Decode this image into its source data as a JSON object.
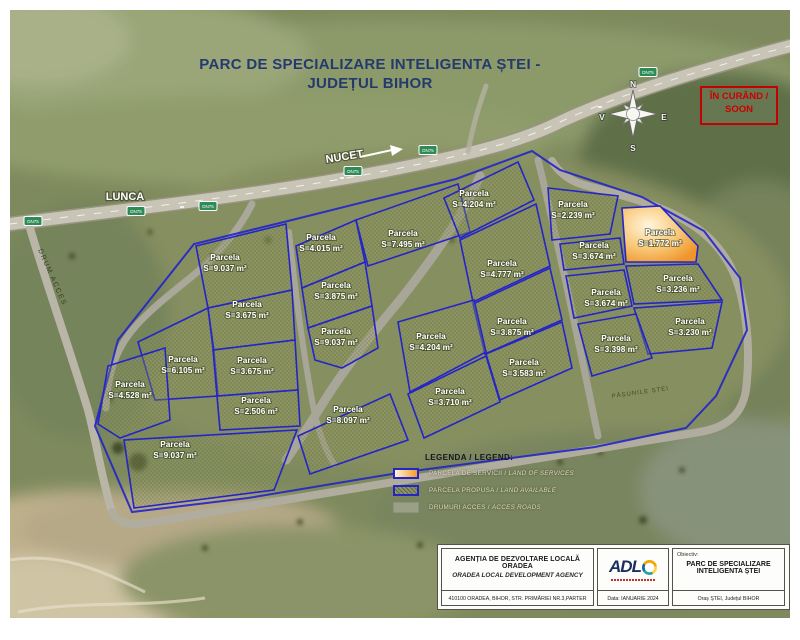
{
  "page": {
    "title_line1": "PARC DE SPECIALIZARE INTELIGENTA ȘTEI -",
    "title_line2": "JUDEȚUL BIHOR"
  },
  "colors": {
    "title": "#243a6e",
    "parcel_border": "#2424c8",
    "service_fill": "#f49c2c",
    "coming_soon_red": "#cc0000",
    "terrain_green": "#7e8a5d"
  },
  "map": {
    "coming_soon_line1": "ÎN CURÂND /",
    "coming_soon_line2": "SOON",
    "town_left": "LUNCA",
    "town_right": "NUCET",
    "access_road_label": "DRUM ACCES",
    "pasture_label": "PĂȘUNILE ȘTEI",
    "route_badge": "DN75",
    "compass": {
      "north": "N",
      "east": "E",
      "south": "S",
      "west": "V"
    },
    "parcel_word": "Parcela",
    "badges": [
      {
        "x": 33,
        "y": 221
      },
      {
        "x": 136,
        "y": 211
      },
      {
        "x": 208,
        "y": 206
      },
      {
        "x": 353,
        "y": 171
      },
      {
        "x": 428,
        "y": 150
      },
      {
        "x": 648,
        "y": 72
      }
    ],
    "service_parcel": {
      "area": "S=1.772 m²",
      "x": 660,
      "y": 237,
      "points": "622,208 660,206 698,246 696,262 626,262"
    },
    "parcels": [
      {
        "area": "S=9.037 m²",
        "x": 225,
        "y": 262,
        "points": "196,246 286,224 292,290 208,308"
      },
      {
        "area": "S=3.675 m²",
        "x": 247,
        "y": 309,
        "points": "208,308 292,290 295,340 213,350"
      },
      {
        "area": "S=6.105 m²",
        "x": 183,
        "y": 364,
        "points": "138,342 208,308 214,352 218,396 155,400"
      },
      {
        "area": "S=3.675 m²",
        "x": 252,
        "y": 365,
        "points": "213,350 295,340 298,390 217,396"
      },
      {
        "area": "S=4.528 m²",
        "x": 130,
        "y": 389,
        "points": "98,424 108,366 165,348 170,420 120,438"
      },
      {
        "area": "S=2.506 m²",
        "x": 256,
        "y": 405,
        "points": "217,396 298,390 300,426 220,430"
      },
      {
        "area": "S=9.037 m²",
        "x": 175,
        "y": 449,
        "points": "124,440 297,430 274,490 134,508"
      },
      {
        "area": "S=4.015 m²",
        "x": 321,
        "y": 242,
        "points": "296,246 356,220 365,262 302,288"
      },
      {
        "area": "S=7.495 m²",
        "x": 403,
        "y": 238,
        "points": "356,220 458,184 470,232 368,266"
      },
      {
        "area": "S=3.875 m²",
        "x": 336,
        "y": 290,
        "points": "302,288 365,262 372,306 308,328"
      },
      {
        "area": "S=9.037 m²",
        "x": 336,
        "y": 336,
        "points": "308,328 372,306 378,348 342,368 315,360"
      },
      {
        "area": "S=4.204 m²",
        "x": 474,
        "y": 198,
        "points": "444,198 518,162 534,200 460,238"
      },
      {
        "area": "S=4.777 m²",
        "x": 502,
        "y": 268,
        "points": "460,240 536,204 550,266 473,302"
      },
      {
        "area": "S=3.875 m²",
        "x": 512,
        "y": 326,
        "points": "473,304 550,268 562,320 485,354"
      },
      {
        "area": "S=4.204 m²",
        "x": 431,
        "y": 341,
        "points": "398,322 474,300 486,352 410,392"
      },
      {
        "area": "S=3.583 m²",
        "x": 524,
        "y": 367,
        "points": "486,354 562,322 572,368 500,400"
      },
      {
        "area": "S=3.710 m²",
        "x": 450,
        "y": 396,
        "points": "408,394 486,356 500,402 424,438"
      },
      {
        "area": "S=8.097 m²",
        "x": 348,
        "y": 414,
        "points": "298,436 390,394 408,440 310,474"
      },
      {
        "area": "S=2.239 m²",
        "x": 573,
        "y": 209,
        "points": "548,188 618,196 610,234 552,240"
      },
      {
        "area": "S=3.674 m²",
        "x": 594,
        "y": 250,
        "points": "560,244 620,238 624,264 564,270"
      },
      {
        "area": "S=3.236 m²",
        "x": 678,
        "y": 283,
        "points": "626,266 698,264 722,300 634,304"
      },
      {
        "area": "S=3.674 m²",
        "x": 606,
        "y": 297,
        "points": "566,276 624,270 632,306 574,318"
      },
      {
        "area": "S=3.230 m²",
        "x": 690,
        "y": 326,
        "points": "634,308 722,302 712,348 648,354"
      },
      {
        "area": "S=3.398 m²",
        "x": 616,
        "y": 343,
        "points": "578,324 636,314 652,358 592,376"
      }
    ]
  },
  "legend": {
    "title": "LEGENDA / LEGEND:",
    "items": [
      {
        "ro": "PARCELA DE SERVICII",
        "en": "LAND OF SERVICES",
        "type": "service"
      },
      {
        "ro": "PARCELA PROPUSA",
        "en": "LAND AVAILABLE",
        "type": "available"
      },
      {
        "ro": "DRUMURI ACCES",
        "en": "ACCES ROADS",
        "type": "road"
      }
    ]
  },
  "title_block": {
    "agency_ro": "AGENȚIA DE DEZVOLTARE LOCALĂ ORADEA",
    "agency_en": "ORADEA LOCAL DEVELOPMENT AGENCY",
    "address": "410100 ORADEA, BIHOR, STR. PRIMĂRIEI NR.3,PARTER",
    "logo_text": "ADL",
    "date_label": "Data: IANUARIE 2024",
    "objective_label": "Obiectiv:",
    "objective_line1": "PARC DE SPECIALIZARE",
    "objective_line2": "INTELIGENTA ȘTEI",
    "location": "Oraș ȘTEI, Județul BIHOR"
  }
}
